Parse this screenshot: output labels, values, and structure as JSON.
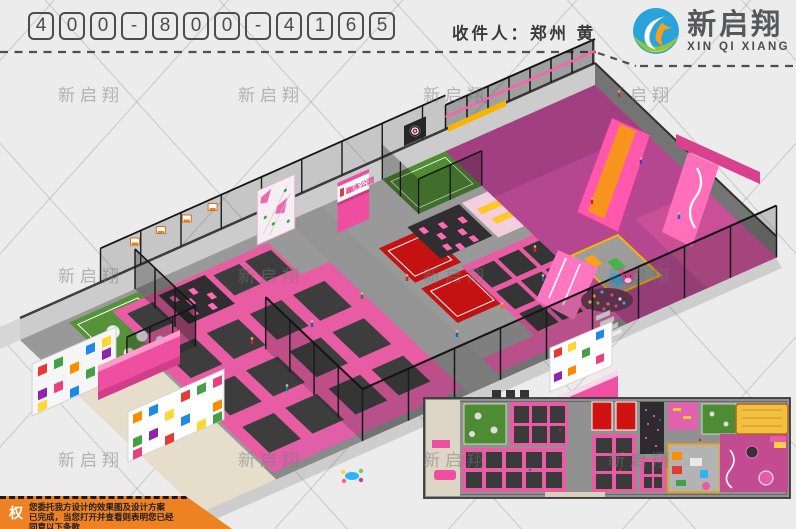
{
  "header": {
    "phone_digits": [
      "4",
      "0",
      "0",
      "-",
      "8",
      "0",
      "0",
      "-",
      "4",
      "1",
      "6",
      "5"
    ],
    "recipient": "收件人：郑州 黄",
    "logo": {
      "name": "新启翔",
      "subtitle": "XIN QI XIANG"
    }
  },
  "watermark": {
    "text": "新启翔"
  },
  "scene": {
    "sign_label": "蹦床公园"
  },
  "copyright": {
    "seal": "权",
    "line1": "您委托我方设计的效果图及设计方案",
    "line2": "已完成，当您打开并查看则表明您已经",
    "line3": "同意以下条款"
  },
  "colors": {
    "accent_pink": "#ec5da5",
    "deep_pink": "#ef4fa0",
    "court_red": "#cf1313",
    "turf_green": "#4e8c33",
    "slide_yellow": "#f0c040",
    "frame_black": "#1c1c1c",
    "logo_blue": "#2aa2db",
    "logo_green": "#8dc63f",
    "banner_orange": "#ee8222"
  }
}
